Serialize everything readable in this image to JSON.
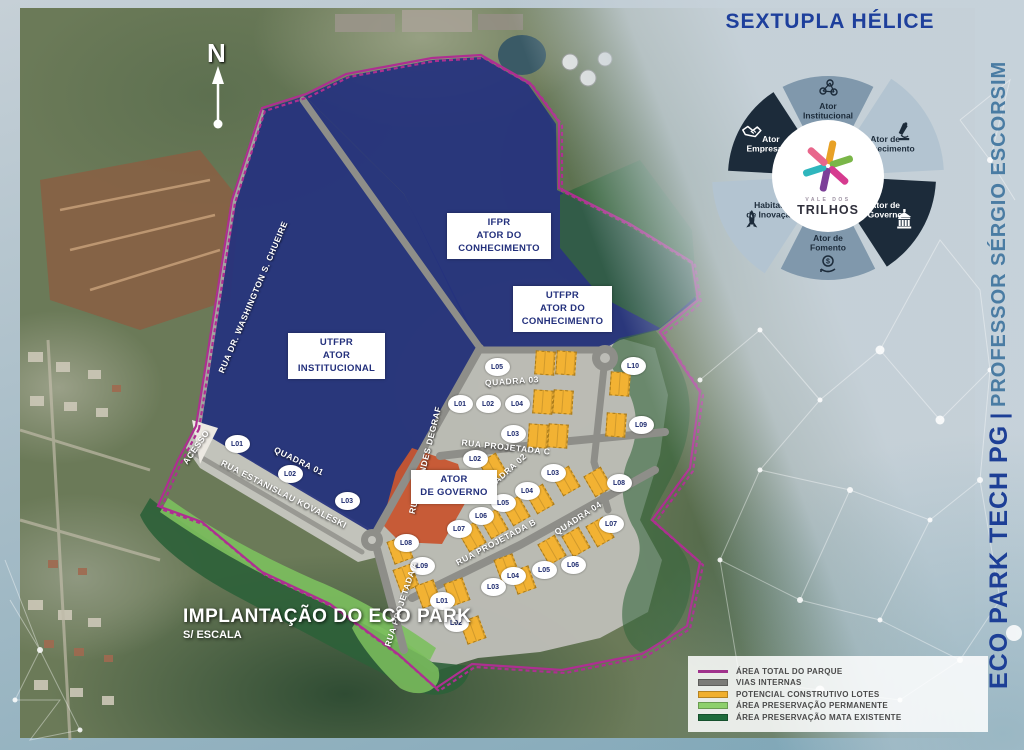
{
  "map": {
    "compass_label": "N",
    "title": "IMPLANTAÇÃO DO ECO PARK",
    "subtitle": "S/ ESCALA",
    "area_labels": [
      {
        "id": "ifpr",
        "lines": [
          "IFPR",
          "ATOR DO",
          "CONHECIMENTO"
        ],
        "x": 447,
        "y": 213,
        "w": 92
      },
      {
        "id": "utfpr-conhecimento",
        "lines": [
          "UTFPR",
          "ATOR DO",
          "CONHECIMENTO"
        ],
        "x": 513,
        "y": 286,
        "w": 87
      },
      {
        "id": "utfpr-institucional",
        "lines": [
          "UTFPR",
          "ATOR",
          "INSTITUCIONAL"
        ],
        "x": 288,
        "y": 333,
        "w": 85
      },
      {
        "id": "ator-governo",
        "lines": [
          "ATOR",
          "DE GOVERNO"
        ],
        "x": 411,
        "y": 470,
        "w": 74
      }
    ],
    "street_labels": [
      {
        "t": "RUA DR. WASHINGTON S. CHUEIRE",
        "x": 253,
        "y": 297,
        "r": -67
      },
      {
        "t": "ACESSO",
        "x": 196,
        "y": 447,
        "r": -55
      },
      {
        "t": "QUADRA 01",
        "x": 299,
        "y": 461,
        "r": 26
      },
      {
        "t": "RUA ESTANISLAU KOVALESKI",
        "x": 284,
        "y": 494,
        "r": 27
      },
      {
        "t": "RUA LEONDES DEGRAF",
        "x": 425,
        "y": 460,
        "r": -76
      },
      {
        "t": "RUA PROJETADA C",
        "x": 506,
        "y": 447,
        "r": 6
      },
      {
        "t": "QUADRA 03",
        "x": 512,
        "y": 381,
        "r": -4
      },
      {
        "t": "QUADRA 02",
        "x": 505,
        "y": 473,
        "r": -42
      },
      {
        "t": "RUA PROJETADA B",
        "x": 496,
        "y": 542,
        "r": -28
      },
      {
        "t": "QUADRA 04",
        "x": 578,
        "y": 518,
        "r": -33
      },
      {
        "t": "RUA PROJETADA A",
        "x": 401,
        "y": 604,
        "r": -72
      }
    ],
    "lot_badges": [
      {
        "t": "L01",
        "x": 237,
        "y": 444
      },
      {
        "t": "L02",
        "x": 290,
        "y": 474
      },
      {
        "t": "L03",
        "x": 347,
        "y": 501
      },
      {
        "t": "L05",
        "x": 497,
        "y": 367
      },
      {
        "t": "L10",
        "x": 633,
        "y": 366
      },
      {
        "t": "L01",
        "x": 460,
        "y": 404
      },
      {
        "t": "L02",
        "x": 488,
        "y": 404
      },
      {
        "t": "L04",
        "x": 517,
        "y": 404
      },
      {
        "t": "L03",
        "x": 513,
        "y": 434
      },
      {
        "t": "L09",
        "x": 641,
        "y": 425
      },
      {
        "t": "L02",
        "x": 475,
        "y": 459
      },
      {
        "t": "L03",
        "x": 553,
        "y": 473
      },
      {
        "t": "L08",
        "x": 619,
        "y": 483
      },
      {
        "t": "L04",
        "x": 527,
        "y": 491
      },
      {
        "t": "L05",
        "x": 503,
        "y": 503
      },
      {
        "t": "L06",
        "x": 481,
        "y": 516
      },
      {
        "t": "L07",
        "x": 459,
        "y": 529
      },
      {
        "t": "L08",
        "x": 406,
        "y": 543
      },
      {
        "t": "L07",
        "x": 611,
        "y": 524
      },
      {
        "t": "L09",
        "x": 422,
        "y": 566
      },
      {
        "t": "L06",
        "x": 573,
        "y": 565
      },
      {
        "t": "L05",
        "x": 544,
        "y": 570
      },
      {
        "t": "L04",
        "x": 513,
        "y": 576
      },
      {
        "t": "L03",
        "x": 493,
        "y": 587
      },
      {
        "t": "L01",
        "x": 442,
        "y": 601
      },
      {
        "t": "L02",
        "x": 456,
        "y": 623
      }
    ],
    "construction_lots": [
      {
        "x": 545,
        "y": 363,
        "r": 4
      },
      {
        "x": 566,
        "y": 363,
        "r": 4
      },
      {
        "x": 543,
        "y": 402,
        "r": 4
      },
      {
        "x": 563,
        "y": 402,
        "r": 4
      },
      {
        "x": 538,
        "y": 436,
        "r": 4
      },
      {
        "x": 558,
        "y": 436,
        "r": 4
      },
      {
        "x": 620,
        "y": 384,
        "r": 4
      },
      {
        "x": 616,
        "y": 425,
        "r": 4
      },
      {
        "x": 493,
        "y": 468,
        "r": -30
      },
      {
        "x": 566,
        "y": 481,
        "r": -30
      },
      {
        "x": 598,
        "y": 482,
        "r": -30
      },
      {
        "x": 540,
        "y": 499,
        "r": -30
      },
      {
        "x": 516,
        "y": 511,
        "r": -30
      },
      {
        "x": 494,
        "y": 524,
        "r": -30
      },
      {
        "x": 472,
        "y": 537,
        "r": -30
      },
      {
        "x": 400,
        "y": 550,
        "r": -20
      },
      {
        "x": 406,
        "y": 578,
        "r": -20
      },
      {
        "x": 428,
        "y": 594,
        "r": -20
      },
      {
        "x": 457,
        "y": 592,
        "r": -20
      },
      {
        "x": 507,
        "y": 568,
        "r": -20
      },
      {
        "x": 523,
        "y": 580,
        "r": -20
      },
      {
        "x": 552,
        "y": 550,
        "r": -30
      },
      {
        "x": 576,
        "y": 542,
        "r": -30
      },
      {
        "x": 600,
        "y": 532,
        "r": -30
      },
      {
        "x": 473,
        "y": 630,
        "r": -20
      }
    ],
    "colors": {
      "navy_area": "#25317e",
      "orange_area": "#c75530",
      "lot_yellow": "#f2b233",
      "boundary_magenta": "#ae2f91",
      "boundary_teal": "#2ba8ad",
      "road_gray": "#8e8e89",
      "plateau_gray": "#bdbdb7"
    }
  },
  "helix": {
    "title": "SEXTUPLA HÉLICE",
    "segments": [
      {
        "label_lines": [
          "Ator",
          "Institucional"
        ],
        "icon": "network-icon",
        "color": "#8098ac",
        "text_color": "#1c2b3a"
      },
      {
        "label_lines": [
          "Ator de",
          "Conhecimento"
        ],
        "icon": "microscope-icon",
        "color": "#b3c4d1",
        "text_color": "#1c2b3a"
      },
      {
        "label_lines": [
          "Ator de",
          "Governo"
        ],
        "icon": "government-building-icon",
        "color": "#1c2b3a",
        "text_color": "#ffffff"
      },
      {
        "label_lines": [
          "Ator de",
          "Fomento"
        ],
        "icon": "coin-hand-icon",
        "color": "#8098ac",
        "text_color": "#1c2b3a"
      },
      {
        "label_lines": [
          "Habitats",
          "de Inovação"
        ],
        "icon": "rocket-icon",
        "color": "#b3c4d1",
        "text_color": "#1c2b3a"
      },
      {
        "label_lines": [
          "Ator",
          "Empresarial"
        ],
        "icon": "handshake-icon",
        "color": "#1c2b3a",
        "text_color": "#ffffff"
      }
    ],
    "center_logo": {
      "line1": "VALE DOS",
      "line2": "TRILHOS",
      "star_colors": [
        "#e8a126",
        "#7ab648",
        "#d63b8f",
        "#7c3f98",
        "#2fb6bd",
        "#e8668b"
      ]
    }
  },
  "sidebar_title": {
    "main": "ECO PARK TECH PG",
    "separator": "|",
    "secondary": "PROFESSOR SÉRGIO ESCORSIM"
  },
  "legend": {
    "items": [
      {
        "label": "ÁREA TOTAL DO PARQUE",
        "swatch": "magenta-line",
        "color": "#a0338c"
      },
      {
        "label": "VIAS INTERNAS",
        "swatch": "gray-bar",
        "color": "#7b7b78"
      },
      {
        "label": "POTENCIAL CONSTRUTIVO LOTES",
        "swatch": "yellow-bar",
        "color": "#f0af2e"
      },
      {
        "label": "ÁREA PRESERVAÇÃO PERMANENTE",
        "swatch": "light-green-bar",
        "color": "#8ed06c"
      },
      {
        "label": "ÁREA PRESERVAÇÃO MATA EXISTENTE",
        "swatch": "dark-green-bar",
        "color": "#1e6b3c"
      }
    ]
  }
}
